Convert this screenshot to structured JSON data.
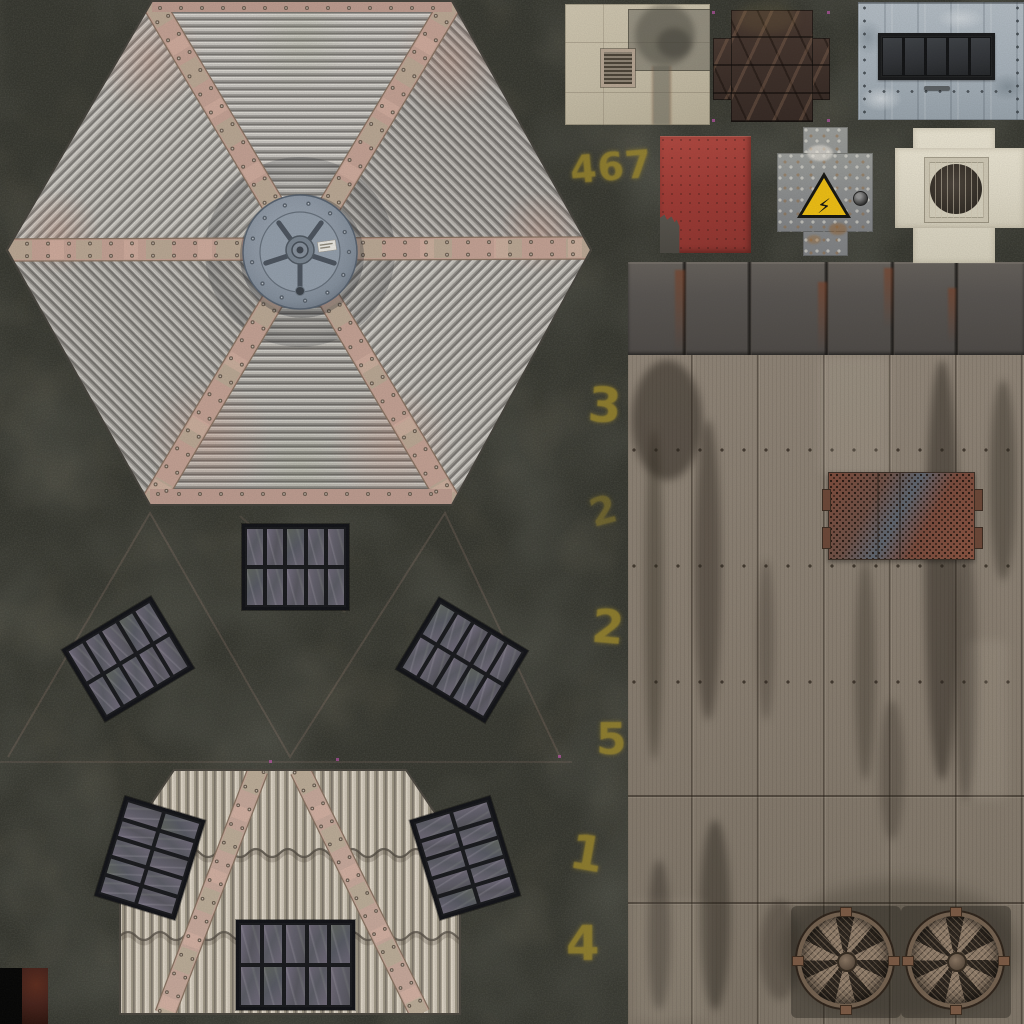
{
  "meta": {
    "title": "rooftop-texture-atlas",
    "image_type": "game texture atlas sheet (building rooftop materials)"
  },
  "painted_numbers": {
    "paint_color": "#a18b2c",
    "items": [
      {
        "value": "467"
      },
      {
        "value": "3"
      },
      {
        "value": "2"
      },
      {
        "value": "2"
      },
      {
        "value": "5"
      },
      {
        "value": "1"
      },
      {
        "value": "4"
      }
    ]
  },
  "warning_sign": {
    "symbol": "⚡",
    "triangle_color": "#eebe12",
    "border_color": "#141410"
  },
  "colors": {
    "gravel_background": "#34352e",
    "hex_roof_ridge_light": "#c6c3bd",
    "hex_roof_ridge_dark": "#7a7772",
    "strap_pink": "#c2a093",
    "strap_patina_green": "#a8b295",
    "hub_blue_gray": "#8e98a5",
    "bottom_roof_light": "#d2cabb",
    "wall_wood": "#887d70",
    "wall_top_band": "#575350",
    "red_tile": "#a03a34",
    "beige_tile": "#c9c0aa",
    "blue_tile": "#adb6be",
    "cream_tile": "#e3ddcb",
    "tread_tile": "#40322b",
    "rust_mesh": "#7e4a38",
    "solar_cell": "#64606e",
    "fan_rust": "#74614f"
  },
  "regions": [
    "hexagonal-corrugated-roof-with-hub",
    "concrete-tile-with-vent-grille",
    "tread-plate-cross-tile",
    "blue-plank-tile-with-window-band",
    "red-metal-tile",
    "warning-cross-tile-high-voltage",
    "cream-cross-tile-with-fan",
    "dark-wall-top-band",
    "wood-plank-wall",
    "rust-mesh-hatch",
    "exhaust-fan-left",
    "exhaust-fan-right",
    "solar-panel-array",
    "bottom-corrugated-roof",
    "uv-seam-guides",
    "painted-uv-numbers"
  ]
}
